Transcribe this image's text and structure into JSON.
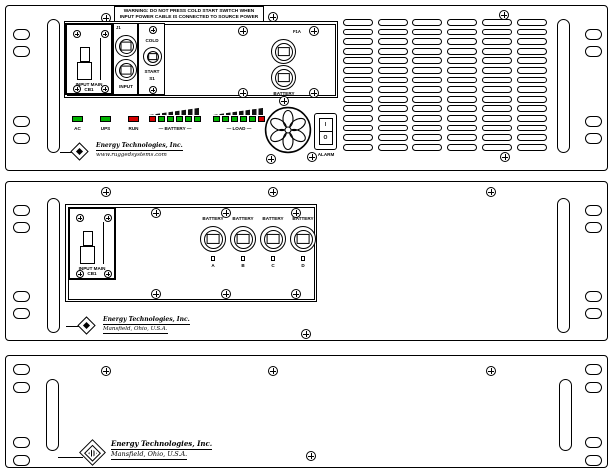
{
  "colors": {
    "led_green": "#00b300",
    "led_red": "#d40000"
  },
  "top_panel": {
    "warning": {
      "line1": "WARNING: DO NOT PRESS COLD START SWITCH WHEN",
      "line2": "INPUT POWER CABLE IS CONNECTED TO SOURCE POWER"
    },
    "breaker": {
      "line1": "INPUT MAIN",
      "line2": "CB1"
    },
    "input_connectors": {
      "ref": "J1",
      "label": "INPUT"
    },
    "cold_start": {
      "line1": "COLD",
      "line2": "START",
      "ref": "S1"
    },
    "output_connectors": {
      "ref": "F1A",
      "label": "BATTERY"
    },
    "indicators": {
      "singles": [
        {
          "label": "AC",
          "state": "green"
        },
        {
          "label": "UPS",
          "state": "green"
        },
        {
          "label": "RUN",
          "state": "red"
        }
      ],
      "battery": {
        "label": "— BATTERY —",
        "states": [
          "red",
          "green",
          "green",
          "green",
          "green",
          "green"
        ]
      },
      "load": {
        "label": "— LOAD —",
        "states": [
          "green",
          "green",
          "green",
          "green",
          "green",
          "red"
        ]
      }
    },
    "alarm_switch": {
      "on": "I",
      "off": "O",
      "label": "ALARM"
    },
    "logo": {
      "line1": "Energy Technologies, Inc.",
      "line2": "www.ruggedsystems.com"
    }
  },
  "middle_panel": {
    "breaker": {
      "line1": "INPUT MAIN",
      "line2": "CB1"
    },
    "battery_connectors": [
      {
        "label": "BATTERY",
        "id": "A"
      },
      {
        "label": "BATTERY",
        "id": "B"
      },
      {
        "label": "BATTERY",
        "id": "C"
      },
      {
        "label": "BATTERY",
        "id": "D"
      }
    ],
    "logo": {
      "line1": "Energy Technologies, Inc.",
      "line2": "Mansfield, Ohio, U.S.A."
    }
  },
  "bottom_panel": {
    "logo": {
      "line1": "Energy Technologies, Inc.",
      "line2": "Mansfield, Ohio, U.S.A."
    }
  }
}
